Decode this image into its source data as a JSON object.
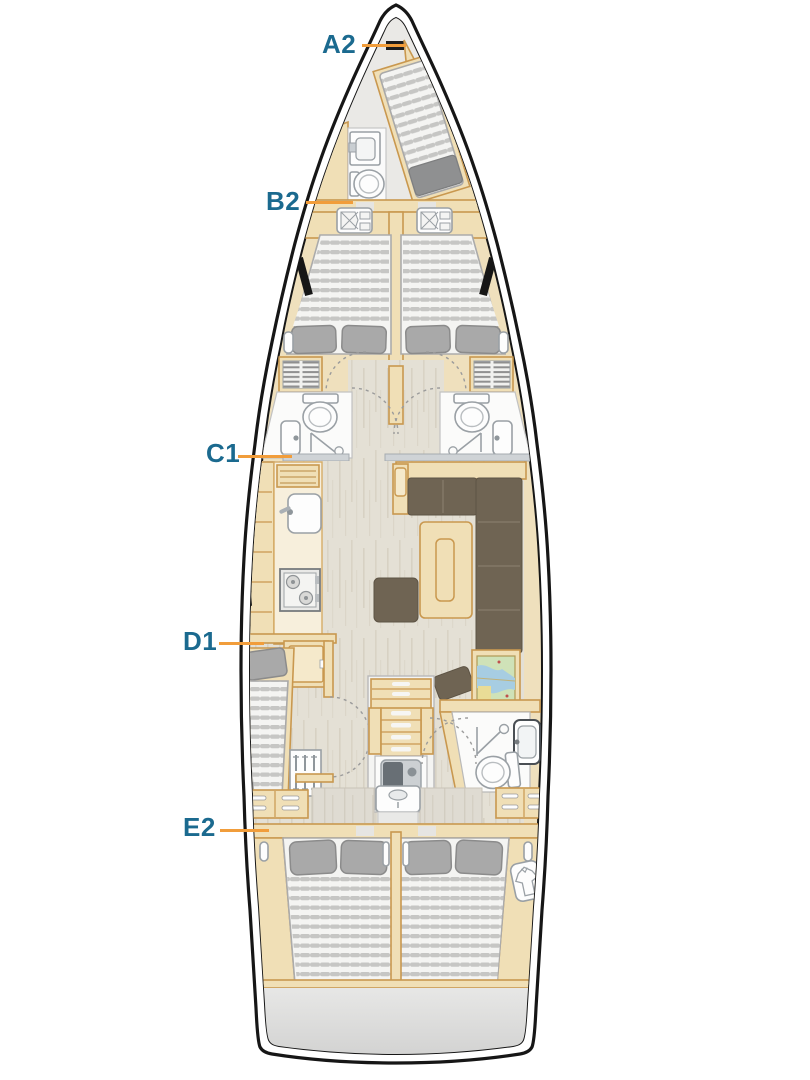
{
  "diagram": {
    "type": "yacht-deck-plan",
    "labels": [
      {
        "text": "A2",
        "points_to": "bow-cabin"
      },
      {
        "text": "B2",
        "points_to": "forward-cabins-bulkhead"
      },
      {
        "text": "C1",
        "points_to": "port-bathroom"
      },
      {
        "text": "D1",
        "points_to": "mid-port-cabin"
      },
      {
        "text": "E2",
        "points_to": "aft-port-cabin"
      }
    ],
    "colors": {
      "label_text": "#1b6a8f",
      "leader_line": "#f19d3b",
      "hull_outline": "#161616",
      "wood": "#f0dfb6",
      "wood_border": "#c9984f",
      "floor": "#e4e0d5",
      "sofa": "#6f6453",
      "pillow": "#a9a9a9",
      "mattress_stripe": "#c6c6c4",
      "stern_platform": "#d9d9d9"
    },
    "icons": [
      "toilet-icon",
      "sink-icon",
      "shower-icon",
      "stove-icon",
      "chart-map-icon",
      "stairs-icon",
      "engine-icon",
      "shirt-locker-icon",
      "bed-icon",
      "pillow-icon",
      "door-swing-icon",
      "hull-window-icon",
      "drawer-handle-icon"
    ]
  }
}
